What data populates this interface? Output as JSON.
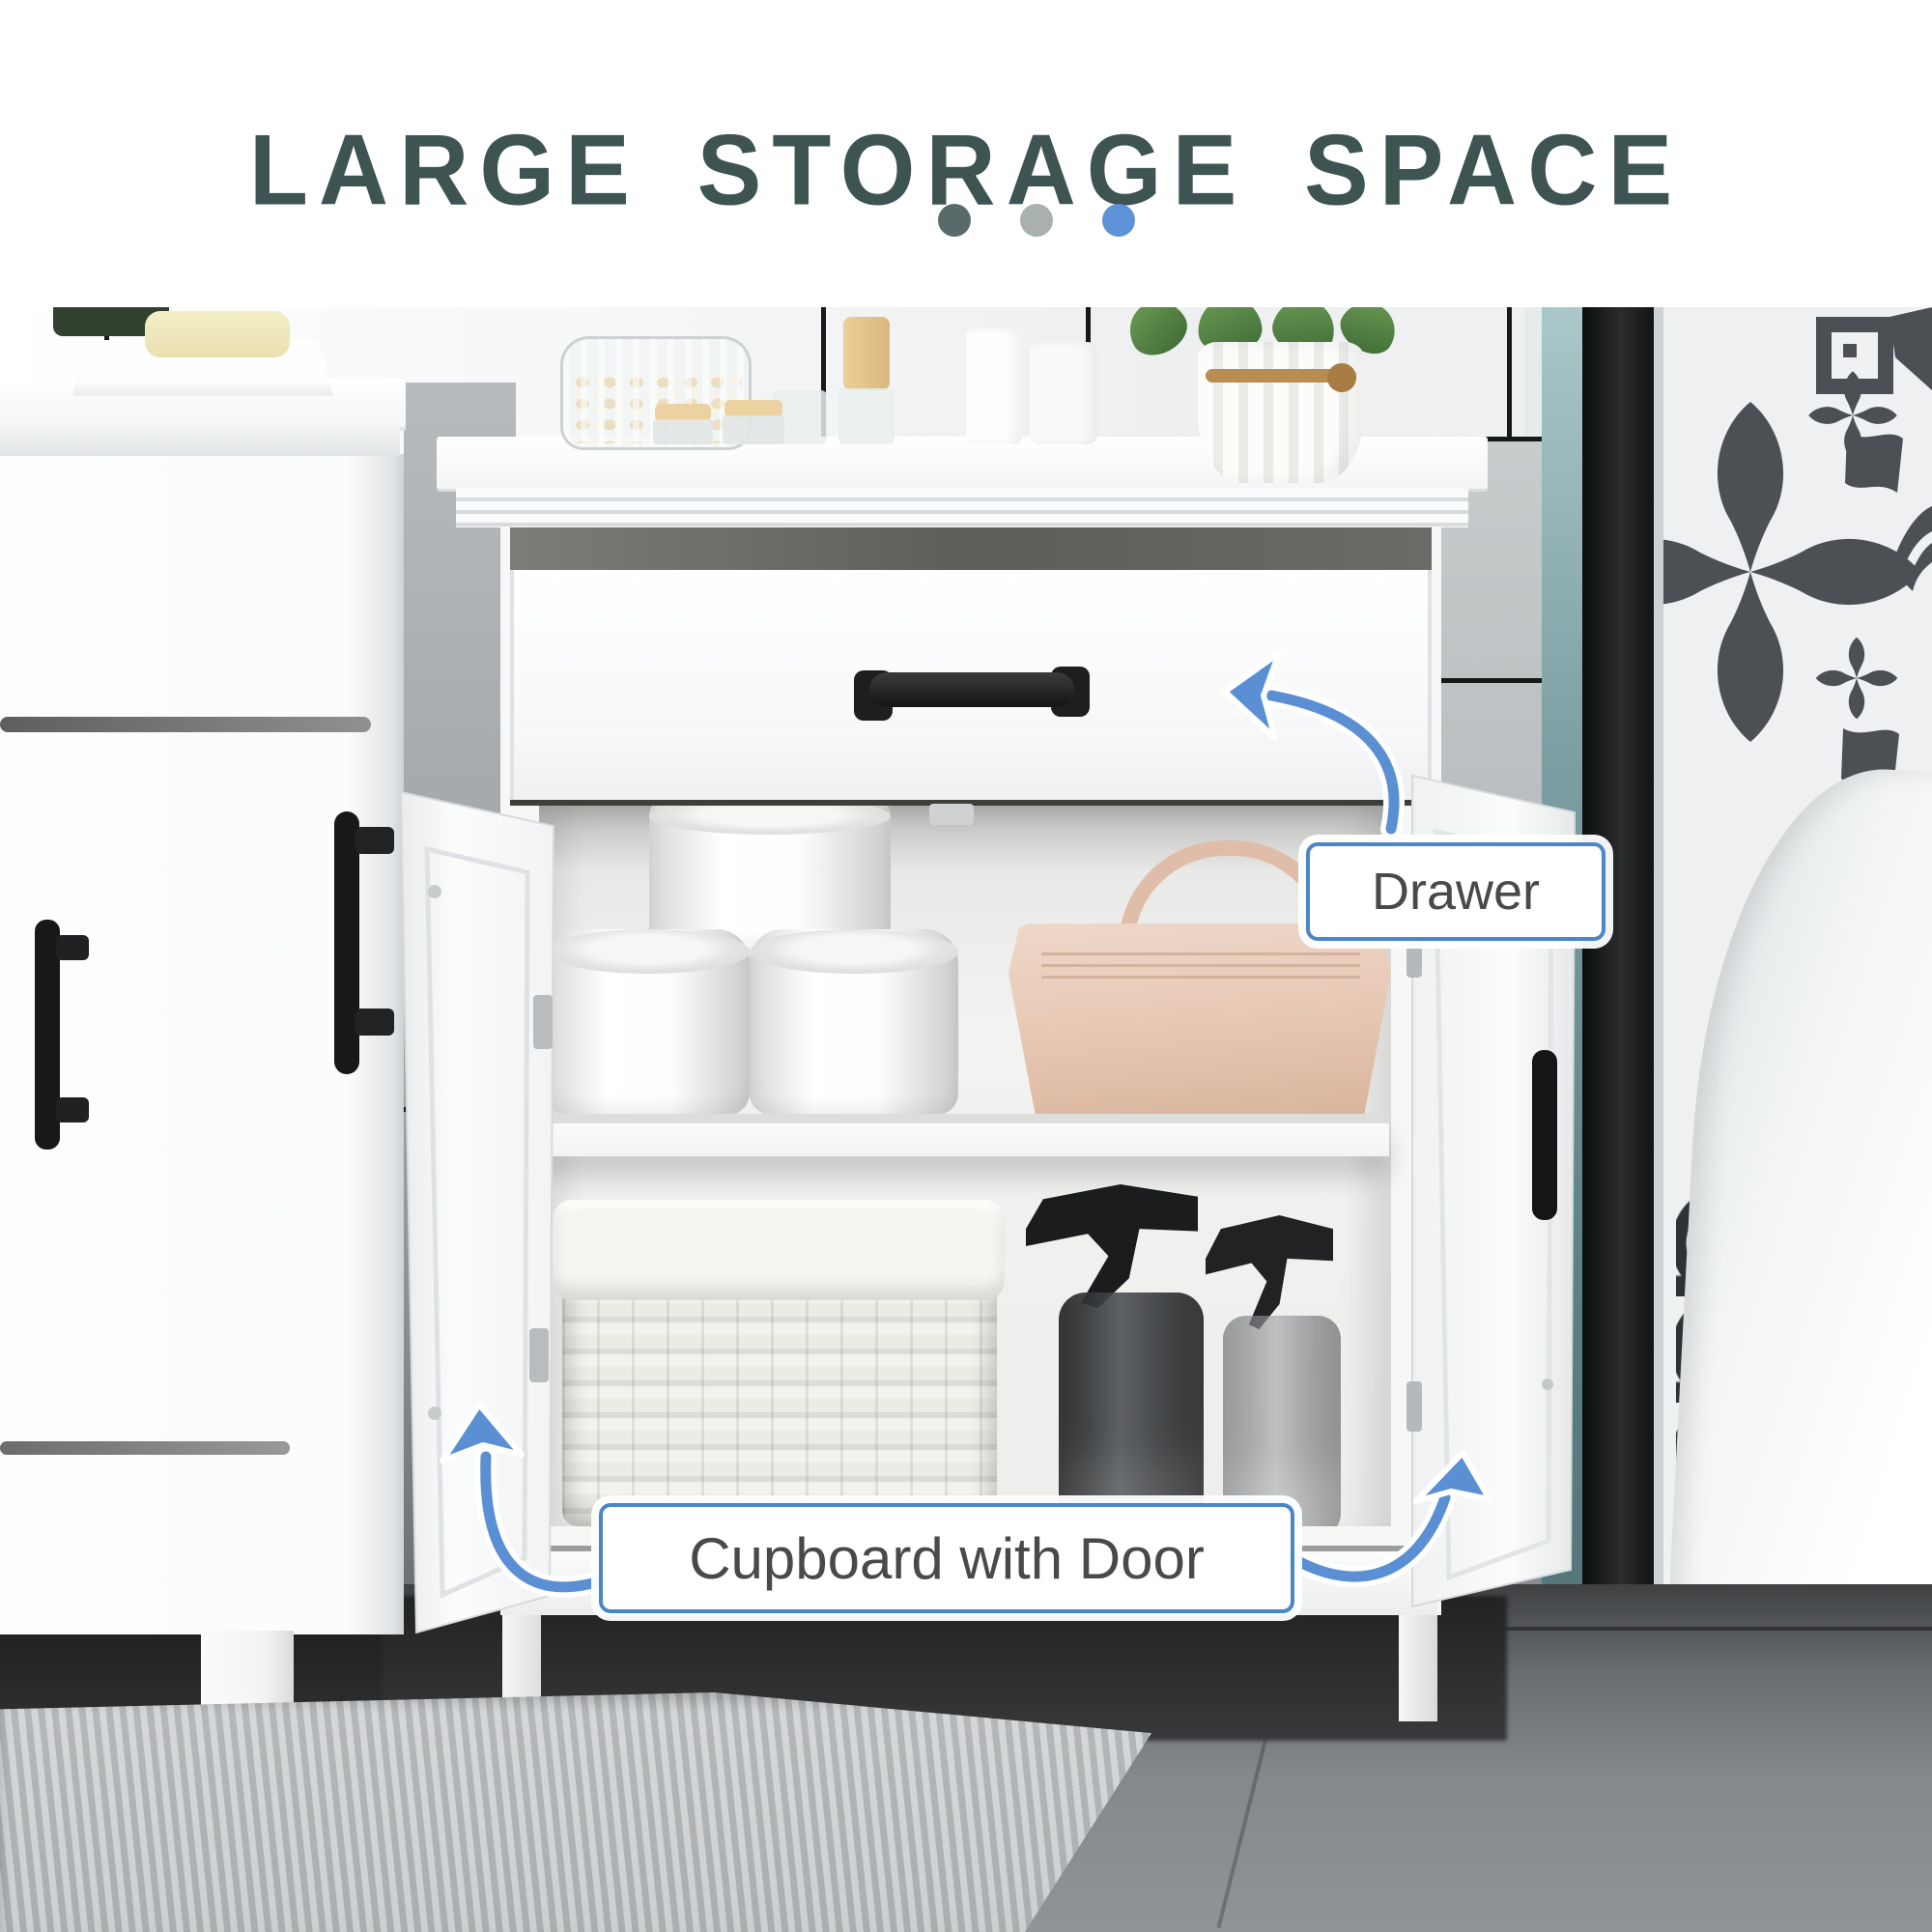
{
  "header": {
    "title": "LARGE STORAGE SPACE",
    "title_color": "#3e5452",
    "pagination_dots": [
      {
        "name": "dot-1",
        "color": "#5a6a6b"
      },
      {
        "name": "dot-2",
        "color": "#a9b0b0"
      },
      {
        "name": "dot-3",
        "color": "#5e92d8"
      }
    ]
  },
  "callouts": {
    "drawer": {
      "label": "Drawer"
    },
    "cupboard": {
      "label": "Cupboard with Door"
    },
    "style": {
      "border_color": "#4a86c8",
      "text_color": "#47494b",
      "background": "#ffffff",
      "arrow_color": "#5b8fd3",
      "arrow_outline": "#ffffff"
    }
  },
  "scene": {
    "objects": [
      "bathroom-storage-cabinet",
      "open-drawer",
      "drawer-handle",
      "open-left-door",
      "open-right-door",
      "toilet-paper-rolls",
      "beige-handbag",
      "middle-shelf",
      "wicker-basket",
      "spray-bottles",
      "cotton-swab-jar",
      "frosted-bottles",
      "white-vase-with-plant",
      "soap-tray",
      "vanity-cabinet",
      "tiled-wall",
      "shower-glass-panel",
      "patterned-wall",
      "bathtub",
      "gray-rug",
      "tile-floor"
    ]
  }
}
